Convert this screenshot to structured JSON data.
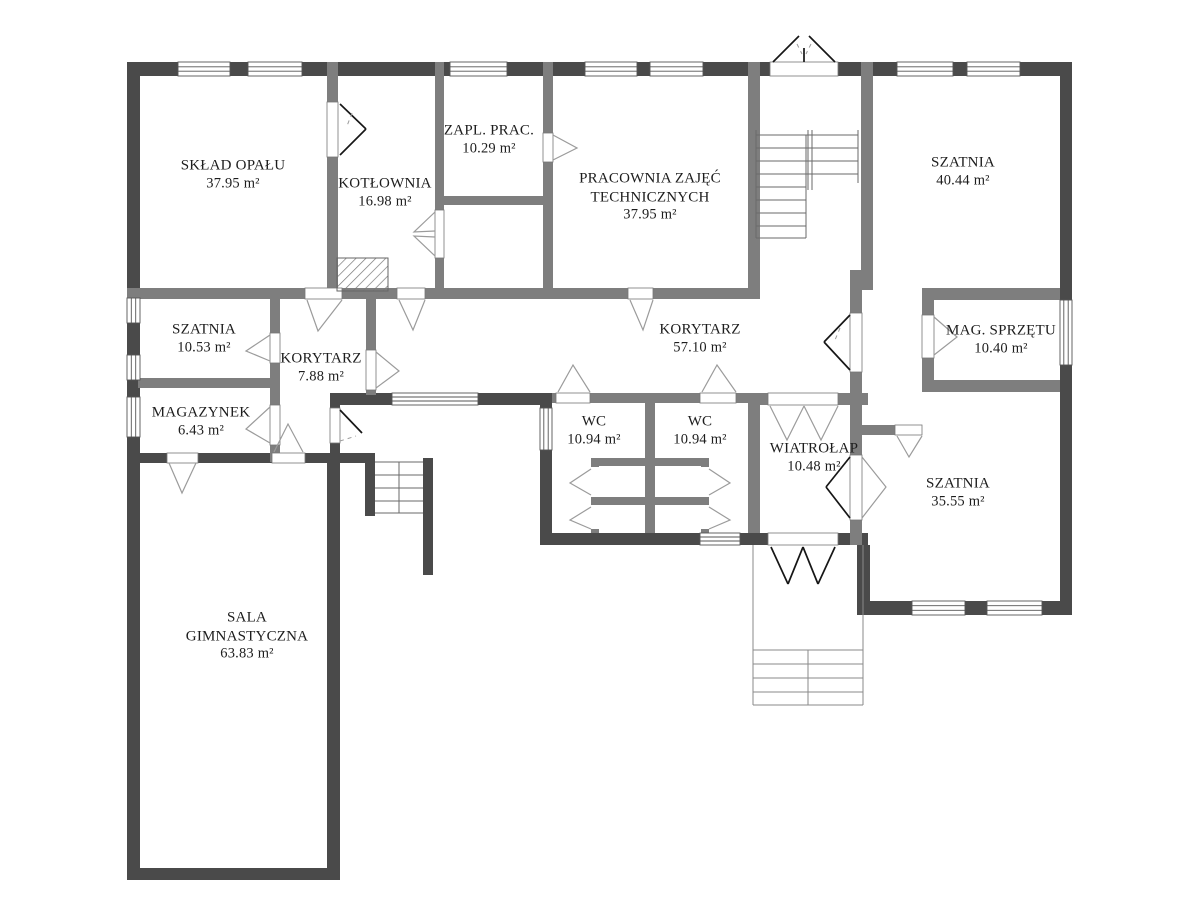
{
  "rooms": [
    {
      "name": "SKŁAD OPAŁU",
      "area": "37.95 m²"
    },
    {
      "name": "KOTŁOWNIA",
      "area": "16.98 m²"
    },
    {
      "name": "ZAPL. PRAC.",
      "area": "10.29 m²"
    },
    {
      "name": "PRACOWNIA ZAJĘĆ TECHNICZNYCH",
      "area": "37.95 m²"
    },
    {
      "name": "SZATNIA",
      "area": "40.44 m²"
    },
    {
      "name": "SZATNIA",
      "area": "10.53 m²"
    },
    {
      "name": "KORYTARZ",
      "area": "7.88 m²"
    },
    {
      "name": "KORYTARZ",
      "area": "57.10 m²"
    },
    {
      "name": "MAG. SPRZĘTU",
      "area": "10.40 m²"
    },
    {
      "name": "MAGAZYNEK",
      "area": "6.43 m²"
    },
    {
      "name": "WC",
      "area": "10.94 m²"
    },
    {
      "name": "WC",
      "area": "10.94 m²"
    },
    {
      "name": "WIATROŁAP",
      "area": "10.48 m²"
    },
    {
      "name": "SZATNIA",
      "area": "35.55 m²"
    },
    {
      "name": "SALA GIMNASTYCZNA",
      "area": "63.83 m²"
    }
  ],
  "colors": {
    "exterior_wall": "#4a4a4a",
    "interior_wall": "#7e7e7e",
    "door_swing": "#9b9b9b",
    "door_leaf": "#161616",
    "stair_line": "#6a6a6a",
    "text": "#1d1d1d",
    "background": "#ffffff"
  }
}
